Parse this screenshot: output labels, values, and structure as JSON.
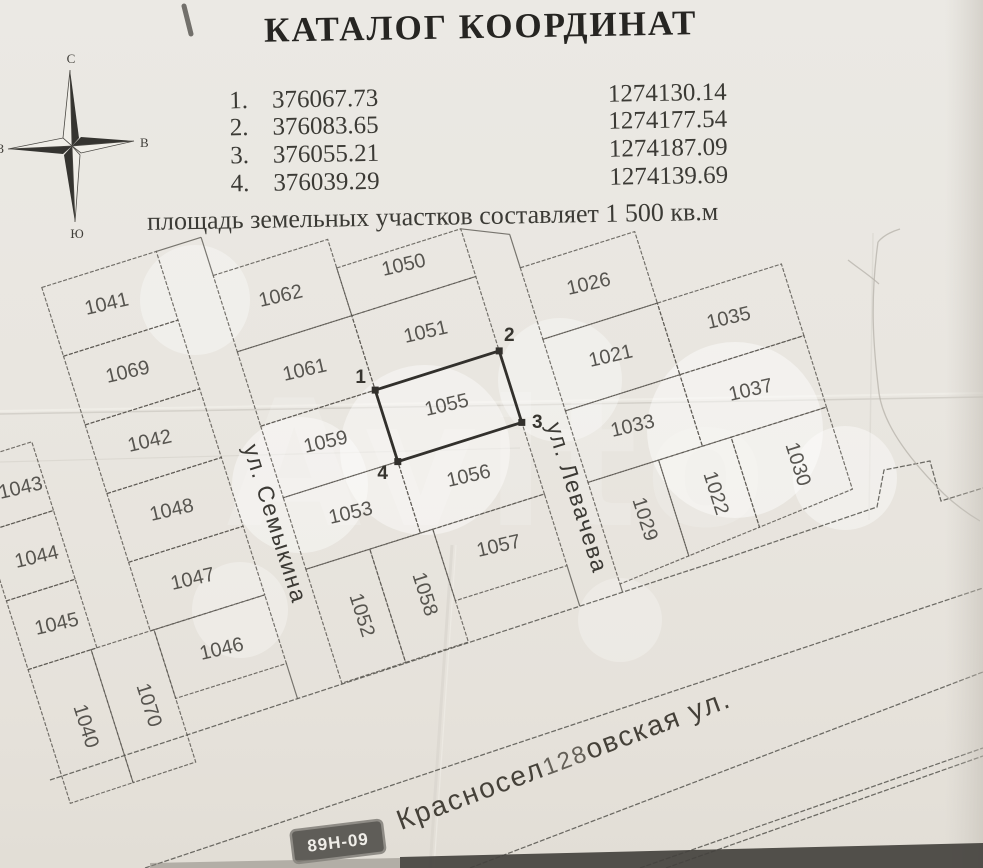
{
  "title": "КАТАЛОГ КООРДИНАТ",
  "coordinates": {
    "rows": [
      {
        "n": "1.",
        "x": "376067.73",
        "y": "1274130.14"
      },
      {
        "n": "2.",
        "x": "376083.65",
        "y": "1274177.54"
      },
      {
        "n": "3.",
        "x": "376055.21",
        "y": "1274187.09"
      },
      {
        "n": "4.",
        "x": "376039.29",
        "y": "1274139.69"
      }
    ]
  },
  "area_note": "площадь земельных участков составляет 1 500 кв.м",
  "compass": {
    "north": "С",
    "south": "Ю",
    "west": "З",
    "east": "В"
  },
  "watermark": "Avito",
  "map": {
    "road_badge": "89Н-09",
    "highlight_parcel": "1055",
    "points": {
      "p1": "1",
      "p2": "2",
      "p3": "3",
      "p4": "4"
    },
    "streets": {
      "semykina": "ул. Семыкина",
      "levacheva": "ул. Левачева",
      "krasnoselovskaya_pre": "Красносел",
      "krasnoselovskaya_mid": "128",
      "krasnoselovskaya_post": "овская ул."
    },
    "parcels": {
      "p1041": "1041",
      "p1069": "1069",
      "p1042": "1042",
      "p1043": "1043",
      "p1048": "1048",
      "p1044": "1044",
      "p1047": "1047",
      "p1045": "1045",
      "p1046": "1046",
      "p1070": "1070",
      "p1040": "1040",
      "p1062": "1062",
      "p1061": "1061",
      "p1059": "1059",
      "p1053": "1053",
      "p1052": "1052",
      "p1058": "1058",
      "p1050": "1050",
      "p1051": "1051",
      "p1055": "1055",
      "p1056": "1056",
      "p1057": "1057",
      "p1026": "1026",
      "p1021": "1021",
      "p1033": "1033",
      "p1035": "1035",
      "p1037": "1037",
      "p1029": "1029",
      "p1022": "1022",
      "p1030": "1030"
    }
  },
  "colors": {
    "paper": "#eae7e1",
    "line": "#5a5751",
    "bold_line": "#32302c",
    "text": "#3b3a35",
    "badge_bg": "#5f5d58"
  }
}
